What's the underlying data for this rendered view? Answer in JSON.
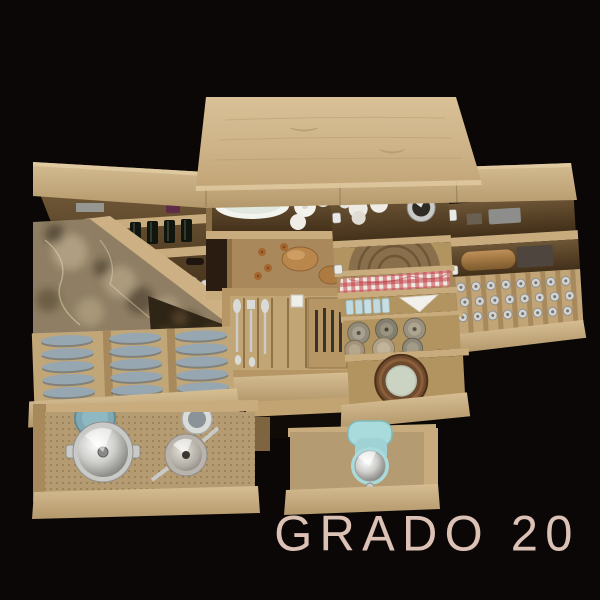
{
  "brand": {
    "label": "GRADO 20"
  },
  "palette": {
    "background": "#0B0706",
    "wood_light": "#DCC49B",
    "wood_mid": "#C3A87C",
    "wood_front": "#C9AC7D",
    "wood_dark": "#8F7347",
    "wood_interior": "#5F4A2E",
    "marble_base": "#8F7E63",
    "marble_dark": "#2F2516",
    "gingham_red": "#C2404A",
    "plate_blue_gray": "#97A7B2",
    "steel": "#D8D8D6",
    "mixer_teal": "#A9DADC",
    "bread": "#B9874C",
    "brand_text": "#DCC1B5"
  },
  "scene": {
    "items": [
      "top-panel",
      "open-shelf-left",
      "wine-bottles",
      "hanging-cups",
      "marble-worktop",
      "tableware-shelf",
      "bread-drawer",
      "cutlery-drawer",
      "jars-shelf",
      "woven-tray",
      "gingham-cloth-drawer",
      "spice-jars-and-napkin-drawer",
      "canister-drawer",
      "wooden-turntable-drawer",
      "storage-boxes-shelf",
      "wine-glass-rack",
      "plate-organizer-drawer",
      "pots-and-pans-drawer",
      "stand-mixer-drawer"
    ]
  }
}
